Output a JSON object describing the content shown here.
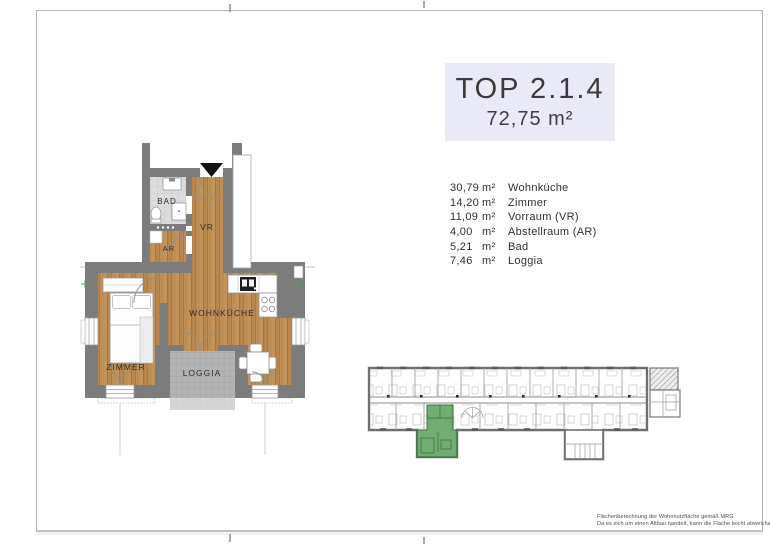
{
  "title": "TOP 2.1.4",
  "area_total": "72,75 m²",
  "rooms": [
    {
      "area": "30,79",
      "unit": "m²",
      "name": "Wohnküche"
    },
    {
      "area": "14,20",
      "unit": "m²",
      "name": "Zimmer"
    },
    {
      "area": "11,09",
      "unit": "m²",
      "name": "Vorraum (VR)"
    },
    {
      "area": "4,00",
      "unit": "m²",
      "name": "Abstellraum (AR)"
    },
    {
      "area": "5,21",
      "unit": "m²",
      "name": "Bad"
    },
    {
      "area": "7,46",
      "unit": "m²",
      "name": "Loggia"
    }
  ],
  "plan_labels": {
    "bad": "BAD",
    "ar": "AR",
    "vr": "VR",
    "wohnkueche": "WOHNKÜCHE",
    "zimmer": "ZIMMER",
    "loggia": "LOGGIA"
  },
  "footer": {
    "line1": "Flächenberechnung der Wohnnutzfläche gemäß MRG",
    "line2": "Da es sich um einen Altbau handelt, kann die Fläche leicht abweichen"
  },
  "colors": {
    "wall": "#7c7c7c",
    "wood": "#b8874f",
    "tile": "#dcdcdc",
    "loggia_floor": "#b3b3b3",
    "highlight_green": "#5fa360",
    "title_bg": "#e9eaf5"
  }
}
